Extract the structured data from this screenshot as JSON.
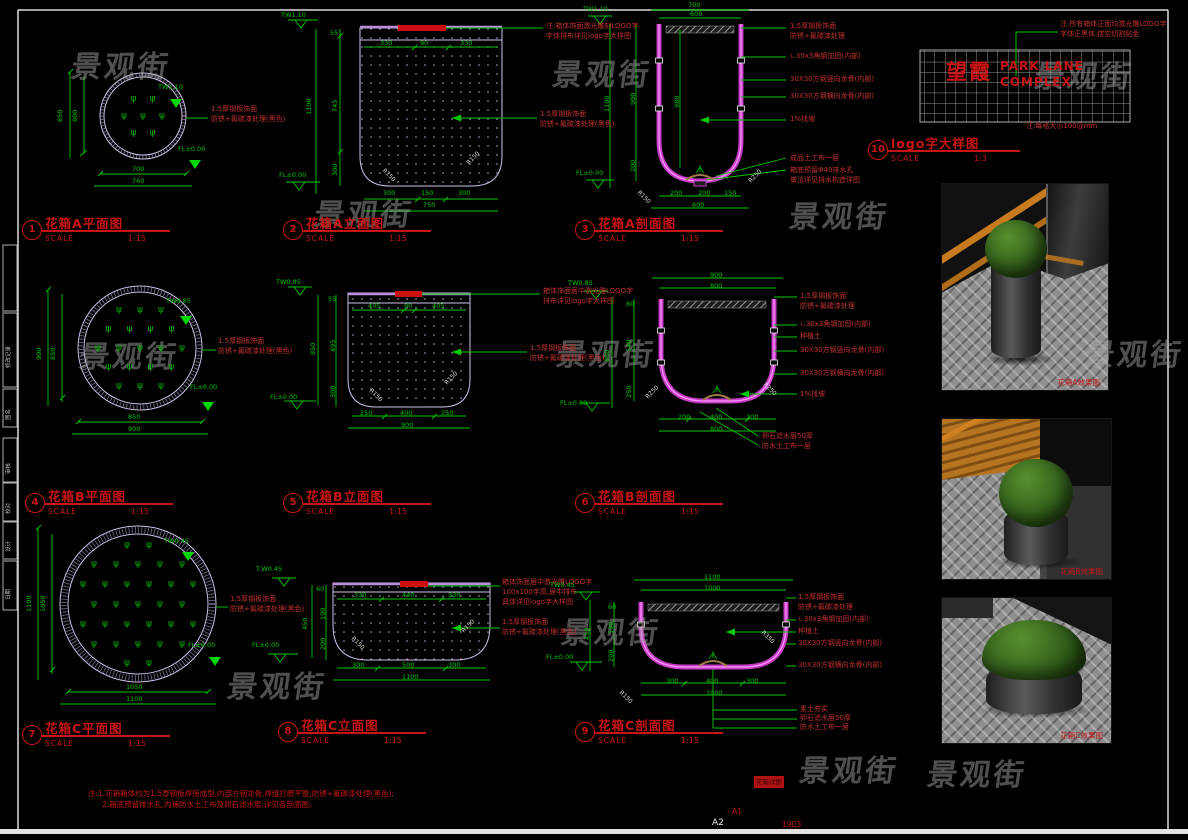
{
  "watermark": {
    "text": "景观街",
    "positions": [
      [
        72,
        42
      ],
      [
        553,
        50
      ],
      [
        315,
        190
      ],
      [
        790,
        192
      ],
      [
        1035,
        52
      ],
      [
        80,
        332
      ],
      [
        557,
        330
      ],
      [
        1085,
        330
      ],
      [
        228,
        662
      ],
      [
        562,
        608
      ],
      [
        800,
        746
      ],
      [
        928,
        750
      ]
    ]
  },
  "drawings": [
    {
      "num": "1",
      "title": "花箱A平面图",
      "scale_label": "SCALE",
      "ratio": "1:15"
    },
    {
      "num": "2",
      "title": "花箱A立面图",
      "scale_label": "SCALE",
      "ratio": "1:15"
    },
    {
      "num": "3",
      "title": "花箱A剖面图",
      "scale_label": "SCALE",
      "ratio": "1:15"
    },
    {
      "num": "4",
      "title": "花箱B平面图",
      "scale_label": "SCALE",
      "ratio": "1:15"
    },
    {
      "num": "5",
      "title": "花箱B立面图",
      "scale_label": "SCALE",
      "ratio": "1:15"
    },
    {
      "num": "6",
      "title": "花箱B剖面图",
      "scale_label": "SCALE",
      "ratio": "1:15"
    },
    {
      "num": "7",
      "title": "花箱C平面图",
      "scale_label": "SCALE",
      "ratio": "1:15"
    },
    {
      "num": "8",
      "title": "花箱C立面图",
      "scale_label": "SCALE",
      "ratio": "1:15"
    },
    {
      "num": "9",
      "title": "花箱C剖面图",
      "scale_label": "SCALE",
      "ratio": "1:15"
    },
    {
      "num": "10",
      "title": "logo字大样图",
      "scale_label": "SCALE",
      "ratio": "1:3"
    }
  ],
  "planters": [
    {
      "cx": 143,
      "cy": 116,
      "r": 30,
      "gap": 19
    },
    {
      "cx": 140,
      "cy": 348,
      "r": 48,
      "gap": 21
    },
    {
      "cx": 138,
      "cy": 604,
      "r": 62,
      "gap": 22
    }
  ],
  "plant_symbol": "ψ",
  "renders": [
    {
      "caption": "花箱A效果图"
    },
    {
      "caption": "花箱B效果图"
    },
    {
      "caption": "花箱C效果图"
    }
  ],
  "misc": {
    "sheet_no": "A2",
    "stamp": "花箱详图",
    "ref": "- A1",
    "code": "1903"
  },
  "texts": [
    {
      "x": 57,
      "y": 122,
      "t": "850",
      "c": "gv"
    },
    {
      "x": 72,
      "y": 122,
      "t": "800",
      "c": "gv"
    },
    {
      "x": 132,
      "y": 166,
      "t": "700",
      "c": "g"
    },
    {
      "x": 132,
      "y": 178,
      "t": "760",
      "c": "g"
    },
    {
      "x": 158,
      "y": 84,
      "t": "TW1.10",
      "c": "g"
    },
    {
      "x": 178,
      "y": 146,
      "t": "FL±0.00",
      "c": "g"
    },
    {
      "x": 211,
      "y": 106,
      "t": "1.5厚钢板饰面",
      "c": "r"
    },
    {
      "x": 211,
      "y": 116,
      "t": "防锈+氟碳漆处理(黑色)",
      "c": "r"
    },
    {
      "x": 306,
      "y": 115,
      "t": "1100",
      "c": "gv"
    },
    {
      "x": 330,
      "y": 30,
      "t": "55",
      "c": "g"
    },
    {
      "x": 332,
      "y": 112,
      "t": "745",
      "c": "gv"
    },
    {
      "x": 332,
      "y": 176,
      "t": "300",
      "c": "gv"
    },
    {
      "x": 380,
      "y": 40,
      "t": "330",
      "c": "g"
    },
    {
      "x": 420,
      "y": 40,
      "t": "90",
      "c": "g"
    },
    {
      "x": 460,
      "y": 40,
      "t": "330",
      "c": "g"
    },
    {
      "x": 383,
      "y": 190,
      "t": "300",
      "c": "g"
    },
    {
      "x": 421,
      "y": 190,
      "t": "150",
      "c": "g"
    },
    {
      "x": 458,
      "y": 190,
      "t": "300",
      "c": "g"
    },
    {
      "x": 423,
      "y": 202,
      "t": "750",
      "c": "g"
    },
    {
      "x": 281,
      "y": 12,
      "t": "TW1.10",
      "c": "g"
    },
    {
      "x": 279,
      "y": 172,
      "t": "FL±0.00",
      "c": "g"
    },
    {
      "x": 546,
      "y": 23,
      "t": "注:箱体饰面激光雕刻LOGO字",
      "c": "r"
    },
    {
      "x": 546,
      "y": 33,
      "t": "字体排布详见logo字大样图",
      "c": "r"
    },
    {
      "x": 540,
      "y": 111,
      "t": "1.5厚钢板饰面",
      "c": "r"
    },
    {
      "x": 540,
      "y": 121,
      "t": "防锈+氟碳漆处理(黑色)",
      "c": "r"
    },
    {
      "x": 385,
      "y": 168,
      "t": "R150",
      "c": "w",
      "r": 45
    },
    {
      "x": 466,
      "y": 162,
      "t": "R150",
      "c": "w",
      "r": -45
    },
    {
      "x": 688,
      "y": 2,
      "t": "700",
      "c": "g"
    },
    {
      "x": 690,
      "y": 11,
      "t": "600",
      "c": "g"
    },
    {
      "x": 604,
      "y": 112,
      "t": "1100",
      "c": "gv"
    },
    {
      "x": 630,
      "y": 105,
      "t": "900",
      "c": "gv"
    },
    {
      "x": 630,
      "y": 172,
      "t": "200",
      "c": "gv"
    },
    {
      "x": 674,
      "y": 108,
      "t": "980",
      "c": "gv"
    },
    {
      "x": 583,
      "y": 6,
      "t": "TW1.10",
      "c": "g"
    },
    {
      "x": 576,
      "y": 170,
      "t": "FL±0.00",
      "c": "g"
    },
    {
      "x": 670,
      "y": 190,
      "t": "200",
      "c": "g"
    },
    {
      "x": 698,
      "y": 190,
      "t": "200",
      "c": "g"
    },
    {
      "x": 724,
      "y": 190,
      "t": "150",
      "c": "g"
    },
    {
      "x": 692,
      "y": 202,
      "t": "600",
      "c": "g"
    },
    {
      "x": 640,
      "y": 190,
      "t": "R150",
      "c": "w",
      "r": 45
    },
    {
      "x": 748,
      "y": 180,
      "t": "R250",
      "c": "w",
      "r": -45
    },
    {
      "x": 790,
      "y": 23,
      "t": "1.5厚钢板饰面",
      "c": "r"
    },
    {
      "x": 790,
      "y": 33,
      "t": "防锈+氟碳漆处理",
      "c": "r"
    },
    {
      "x": 790,
      "y": 53,
      "t": "∟30x3角钢加固(内部)",
      "c": "r"
    },
    {
      "x": 790,
      "y": 76,
      "t": "30X30方钢竖向龙骨(内部)",
      "c": "r"
    },
    {
      "x": 790,
      "y": 93,
      "t": "30X30方钢横向龙骨(内部)",
      "c": "r"
    },
    {
      "x": 790,
      "y": 116,
      "t": "1%找坡",
      "c": "r"
    },
    {
      "x": 790,
      "y": 155,
      "t": "成品土工布一层",
      "c": "r"
    },
    {
      "x": 790,
      "y": 167,
      "t": "箱底预留Φ40排水孔",
      "c": "r"
    },
    {
      "x": 790,
      "y": 177,
      "t": "做法详见排水构造详图",
      "c": "r"
    },
    {
      "x": 946,
      "y": 62,
      "t": "望霞",
      "c": "lc"
    },
    {
      "x": 1000,
      "y": 60,
      "t": "PARK LANE",
      "c": "le"
    },
    {
      "x": 1000,
      "y": 76,
      "t": "COMPLEX",
      "c": "le"
    },
    {
      "x": 1060,
      "y": 21,
      "t": "注:所有箱体正面均激光雕LOGO字",
      "c": "r"
    },
    {
      "x": 1060,
      "y": 31,
      "t": "字体正黑体,镂空切割贴金",
      "c": "r"
    },
    {
      "x": 1026,
      "y": 123,
      "t": "注:每格大小100@mm",
      "c": "r"
    },
    {
      "x": 36,
      "y": 360,
      "t": "900",
      "c": "gv"
    },
    {
      "x": 50,
      "y": 360,
      "t": "850",
      "c": "gv"
    },
    {
      "x": 128,
      "y": 414,
      "t": "850",
      "c": "g"
    },
    {
      "x": 128,
      "y": 426,
      "t": "900",
      "c": "g"
    },
    {
      "x": 166,
      "y": 298,
      "t": "TW0.85",
      "c": "g"
    },
    {
      "x": 190,
      "y": 384,
      "t": "FL±0.00",
      "c": "g"
    },
    {
      "x": 218,
      "y": 338,
      "t": "1.5厚钢板饰面",
      "c": "r"
    },
    {
      "x": 218,
      "y": 348,
      "t": "防锈+氟碳漆处理(黑色)",
      "c": "r"
    },
    {
      "x": 310,
      "y": 355,
      "t": "850",
      "c": "gv"
    },
    {
      "x": 328,
      "y": 296,
      "t": "55",
      "c": "g"
    },
    {
      "x": 330,
      "y": 352,
      "t": "495",
      "c": "gv"
    },
    {
      "x": 330,
      "y": 398,
      "t": "300",
      "c": "gv"
    },
    {
      "x": 368,
      "y": 303,
      "t": "405",
      "c": "g"
    },
    {
      "x": 404,
      "y": 303,
      "t": "90",
      "c": "g"
    },
    {
      "x": 432,
      "y": 303,
      "t": "405",
      "c": "g"
    },
    {
      "x": 360,
      "y": 410,
      "t": "250",
      "c": "g"
    },
    {
      "x": 400,
      "y": 410,
      "t": "400",
      "c": "g"
    },
    {
      "x": 441,
      "y": 410,
      "t": "250",
      "c": "g"
    },
    {
      "x": 401,
      "y": 422,
      "t": "900",
      "c": "g"
    },
    {
      "x": 276,
      "y": 279,
      "t": "TW0.85",
      "c": "g"
    },
    {
      "x": 270,
      "y": 394,
      "t": "FL±0.00",
      "c": "g"
    },
    {
      "x": 543,
      "y": 288,
      "t": "箱体饰面居中激光雕LOGO字",
      "c": "r"
    },
    {
      "x": 543,
      "y": 298,
      "t": "排布详见logo字大样图",
      "c": "r"
    },
    {
      "x": 530,
      "y": 345,
      "t": "1.5厚钢板饰面",
      "c": "r"
    },
    {
      "x": 530,
      "y": 355,
      "t": "防锈+氟碳漆处理(黑色)",
      "c": "r"
    },
    {
      "x": 372,
      "y": 388,
      "t": "R150",
      "c": "w",
      "r": 45
    },
    {
      "x": 444,
      "y": 382,
      "t": "R150",
      "c": "w",
      "r": -45
    },
    {
      "x": 710,
      "y": 272,
      "t": "900",
      "c": "g"
    },
    {
      "x": 710,
      "y": 283,
      "t": "800",
      "c": "g"
    },
    {
      "x": 604,
      "y": 362,
      "t": "850",
      "c": "gv"
    },
    {
      "x": 626,
      "y": 301,
      "t": "60",
      "c": "g"
    },
    {
      "x": 626,
      "y": 352,
      "t": "540",
      "c": "gv"
    },
    {
      "x": 626,
      "y": 398,
      "t": "250",
      "c": "gv"
    },
    {
      "x": 568,
      "y": 280,
      "t": "TW0.85",
      "c": "g"
    },
    {
      "x": 560,
      "y": 400,
      "t": "FL±0.00",
      "c": "g"
    },
    {
      "x": 678,
      "y": 414,
      "t": "200",
      "c": "g"
    },
    {
      "x": 710,
      "y": 414,
      "t": "400",
      "c": "g"
    },
    {
      "x": 746,
      "y": 414,
      "t": "200",
      "c": "g"
    },
    {
      "x": 710,
      "y": 426,
      "t": "800",
      "c": "g"
    },
    {
      "x": 800,
      "y": 293,
      "t": "1.5厚钢板饰面",
      "c": "r"
    },
    {
      "x": 800,
      "y": 303,
      "t": "防锈+氟碳漆处理",
      "c": "r"
    },
    {
      "x": 800,
      "y": 321,
      "t": "∟30x3角钢加固(内部)",
      "c": "r"
    },
    {
      "x": 800,
      "y": 333,
      "t": "种植土",
      "c": "r"
    },
    {
      "x": 800,
      "y": 347,
      "t": "30X30方钢竖向龙骨(内部)",
      "c": "r"
    },
    {
      "x": 800,
      "y": 370,
      "t": "30X30方钢横向龙骨(内部)",
      "c": "r"
    },
    {
      "x": 800,
      "y": 391,
      "t": "1%找坡",
      "c": "r"
    },
    {
      "x": 762,
      "y": 433,
      "t": "卵石滤水层50厚",
      "c": "r"
    },
    {
      "x": 762,
      "y": 443,
      "t": "防水土工布一层",
      "c": "r"
    },
    {
      "x": 645,
      "y": 396,
      "t": "R250",
      "c": "w",
      "r": -45
    },
    {
      "x": 766,
      "y": 382,
      "t": "R250",
      "c": "w",
      "r": 45
    },
    {
      "x": 26,
      "y": 612,
      "t": "1100",
      "c": "gv"
    },
    {
      "x": 40,
      "y": 612,
      "t": "1050",
      "c": "gv"
    },
    {
      "x": 126,
      "y": 684,
      "t": "1050",
      "c": "g"
    },
    {
      "x": 126,
      "y": 696,
      "t": "1100",
      "c": "g"
    },
    {
      "x": 164,
      "y": 538,
      "t": "TW0.45",
      "c": "g"
    },
    {
      "x": 188,
      "y": 642,
      "t": "FL±0.00",
      "c": "g"
    },
    {
      "x": 230,
      "y": 596,
      "t": "1.5厚钢板饰面",
      "c": "r"
    },
    {
      "x": 230,
      "y": 606,
      "t": "防锈+氟碳漆处理(黑色)",
      "c": "r"
    },
    {
      "x": 256,
      "y": 566,
      "t": "T.W0.45",
      "c": "g"
    },
    {
      "x": 252,
      "y": 642,
      "t": "FL±0.00",
      "c": "g"
    },
    {
      "x": 302,
      "y": 630,
      "t": "450",
      "c": "gv"
    },
    {
      "x": 316,
      "y": 586,
      "t": "60",
      "c": "g"
    },
    {
      "x": 320,
      "y": 620,
      "t": "190",
      "c": "gv"
    },
    {
      "x": 320,
      "y": 650,
      "t": "200",
      "c": "gv"
    },
    {
      "x": 354,
      "y": 592,
      "t": "330",
      "c": "g"
    },
    {
      "x": 402,
      "y": 592,
      "t": "440",
      "c": "g"
    },
    {
      "x": 448,
      "y": 592,
      "t": "330",
      "c": "g"
    },
    {
      "x": 352,
      "y": 662,
      "t": "300",
      "c": "g"
    },
    {
      "x": 402,
      "y": 662,
      "t": "500",
      "c": "g"
    },
    {
      "x": 448,
      "y": 662,
      "t": "300",
      "c": "g"
    },
    {
      "x": 402,
      "y": 674,
      "t": "1100",
      "c": "g"
    },
    {
      "x": 502,
      "y": 579,
      "t": "箱体饰面居中激光雕LOGO字",
      "c": "r"
    },
    {
      "x": 502,
      "y": 589,
      "t": "100x100字高,居中排布",
      "c": "r"
    },
    {
      "x": 502,
      "y": 599,
      "t": "具体详见logo字大样图",
      "c": "r"
    },
    {
      "x": 502,
      "y": 619,
      "t": "1.5厚钢板饰面",
      "c": "r"
    },
    {
      "x": 502,
      "y": 629,
      "t": "防锈+氟碳漆处理(黑色)",
      "c": "r"
    },
    {
      "x": 354,
      "y": 636,
      "t": "R150",
      "c": "w",
      "r": 45
    },
    {
      "x": 461,
      "y": 630,
      "t": "R150",
      "c": "w",
      "r": -45
    },
    {
      "x": 704,
      "y": 574,
      "t": "1100",
      "c": "g"
    },
    {
      "x": 704,
      "y": 585,
      "t": "1000",
      "c": "g"
    },
    {
      "x": 584,
      "y": 640,
      "t": "450",
      "c": "gv"
    },
    {
      "x": 608,
      "y": 604,
      "t": "60",
      "c": "g"
    },
    {
      "x": 608,
      "y": 634,
      "t": "190",
      "c": "gv"
    },
    {
      "x": 608,
      "y": 662,
      "t": "200",
      "c": "gv"
    },
    {
      "x": 550,
      "y": 582,
      "t": "TW0.45",
      "c": "g"
    },
    {
      "x": 546,
      "y": 654,
      "t": "FL±0.00",
      "c": "g"
    },
    {
      "x": 666,
      "y": 678,
      "t": "300",
      "c": "g"
    },
    {
      "x": 706,
      "y": 678,
      "t": "400",
      "c": "g"
    },
    {
      "x": 746,
      "y": 678,
      "t": "300",
      "c": "g"
    },
    {
      "x": 706,
      "y": 690,
      "t": "1000",
      "c": "g"
    },
    {
      "x": 798,
      "y": 594,
      "t": "1.5厚钢板饰面",
      "c": "r"
    },
    {
      "x": 798,
      "y": 604,
      "t": "防锈+氟碳漆处理",
      "c": "r"
    },
    {
      "x": 798,
      "y": 616,
      "t": "∟30x3角钢加固(内部)",
      "c": "r"
    },
    {
      "x": 798,
      "y": 628,
      "t": "种植土",
      "c": "r"
    },
    {
      "x": 798,
      "y": 640,
      "t": "30X30方钢竖向龙骨(内部)",
      "c": "r"
    },
    {
      "x": 798,
      "y": 662,
      "t": "30X30方钢横向龙骨(内部)",
      "c": "r"
    },
    {
      "x": 800,
      "y": 706,
      "t": "素土夯实",
      "c": "r"
    },
    {
      "x": 800,
      "y": 715,
      "t": "卵石滤水层50厚",
      "c": "r"
    },
    {
      "x": 800,
      "y": 724,
      "t": "防水土工布一层",
      "c": "r"
    },
    {
      "x": 622,
      "y": 690,
      "t": "R150",
      "c": "w",
      "r": 45
    },
    {
      "x": 764,
      "y": 630,
      "t": "R350",
      "c": "w",
      "r": 45
    },
    {
      "x": 88,
      "y": 790,
      "t": "注:1.花箱箱体均为1.5厚钢板焊接成型,内部方钢龙骨,焊缝打磨平整,防锈+氟碳漆处理(黑色);",
      "c": "rs"
    },
    {
      "x": 102,
      "y": 801,
      "t": "2.箱底预留排水孔,内铺防水土工布及卵石滤水层,详见各剖面图。",
      "c": "rs"
    },
    {
      "x": 727,
      "y": 808,
      "t": "- A1",
      "c": "rs"
    },
    {
      "x": 712,
      "y": 819,
      "t": "A2",
      "c": "wl"
    },
    {
      "x": 782,
      "y": 821,
      "t": "1903",
      "c": "rs"
    },
    {
      "x": 7,
      "y": 368,
      "t": "修改记录",
      "c": "fl"
    },
    {
      "x": 7,
      "y": 420,
      "t": "图名",
      "c": "fl"
    },
    {
      "x": 7,
      "y": 474,
      "t": "审核",
      "c": "fl"
    },
    {
      "x": 7,
      "y": 514,
      "t": "校对",
      "c": "fl"
    },
    {
      "x": 7,
      "y": 552,
      "t": "设计",
      "c": "fl"
    },
    {
      "x": 7,
      "y": 600,
      "t": "日期",
      "c": "fl"
    }
  ]
}
